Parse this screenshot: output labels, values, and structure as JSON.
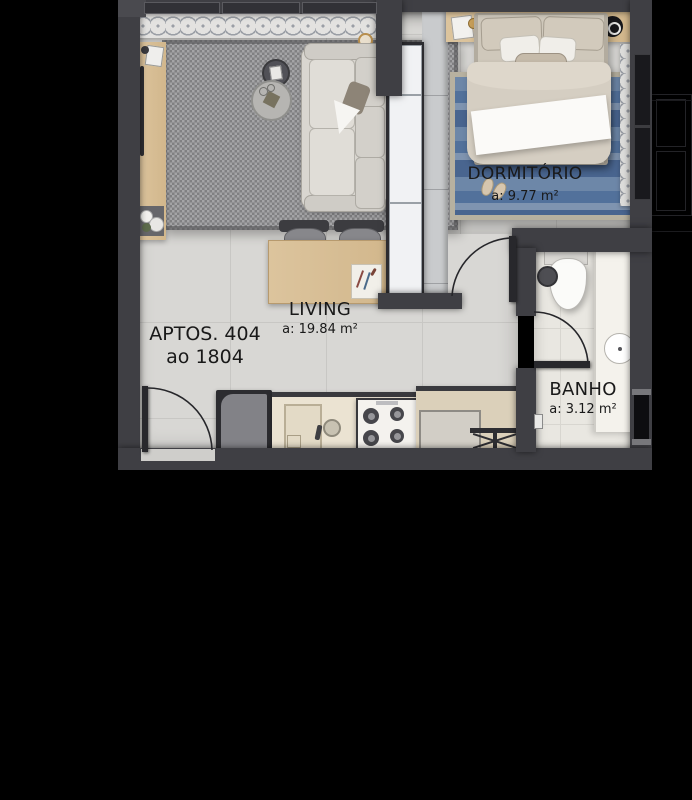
{
  "unit": {
    "line1": "APTOS. 404",
    "line2": "ao 1804"
  },
  "rooms": {
    "dormitorio": {
      "label": "DORMITÓRIO",
      "area": "a: 9.77 m²"
    },
    "living": {
      "label": "LIVING",
      "area": "a: 19.84 m²"
    },
    "banho": {
      "label": "BANHO",
      "area": "a: 3.12 m²"
    }
  },
  "palette": {
    "background": "#000000",
    "wall": "#3f3f44",
    "floor_tile": "#d8d7d4",
    "bath_floor": "#e9e7e1",
    "wood": "#d9c098",
    "living_rug": "#98989b",
    "bedroom_rug_blue": "#5a79a1",
    "bed_linen": "#d6cfc3",
    "kitchen_counter": "#ebe3d2",
    "service_counter": "#dbd0ba",
    "door_line": "#28282c"
  }
}
